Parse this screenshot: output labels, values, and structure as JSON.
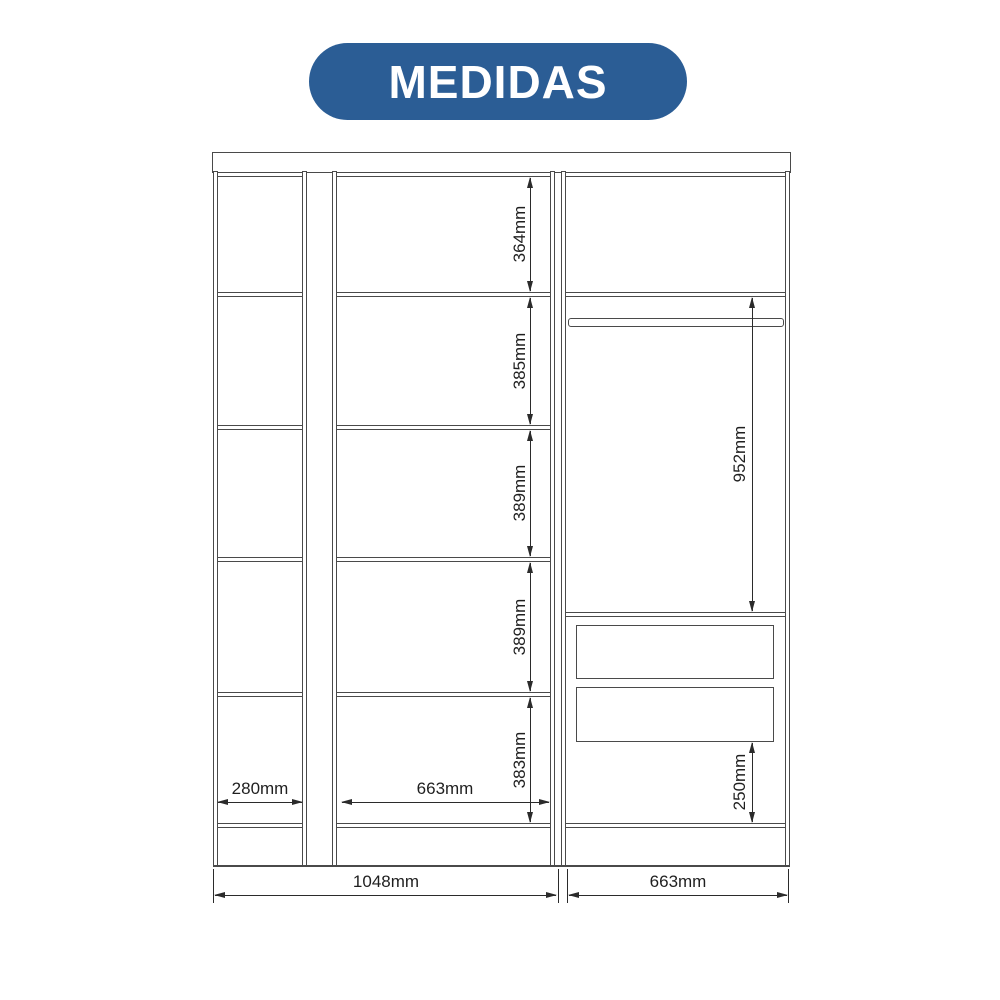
{
  "header": {
    "title": "MEDIDAS",
    "badge_color": "#2b5d95",
    "title_color": "#ffffff"
  },
  "diagram": {
    "unit": "mm",
    "line_color": "#4a4a4a",
    "dim_color": "#2b2b2b",
    "dims": {
      "middle_shelves": [
        "364mm",
        "385mm",
        "389mm",
        "389mm",
        "383mm"
      ],
      "right_hanging_space": "952mm",
      "right_under_drawers": "250mm",
      "left_column_width": "280mm",
      "middle_column_width": "663mm",
      "total_width_left": "1048mm",
      "total_width_right": "663mm"
    }
  }
}
